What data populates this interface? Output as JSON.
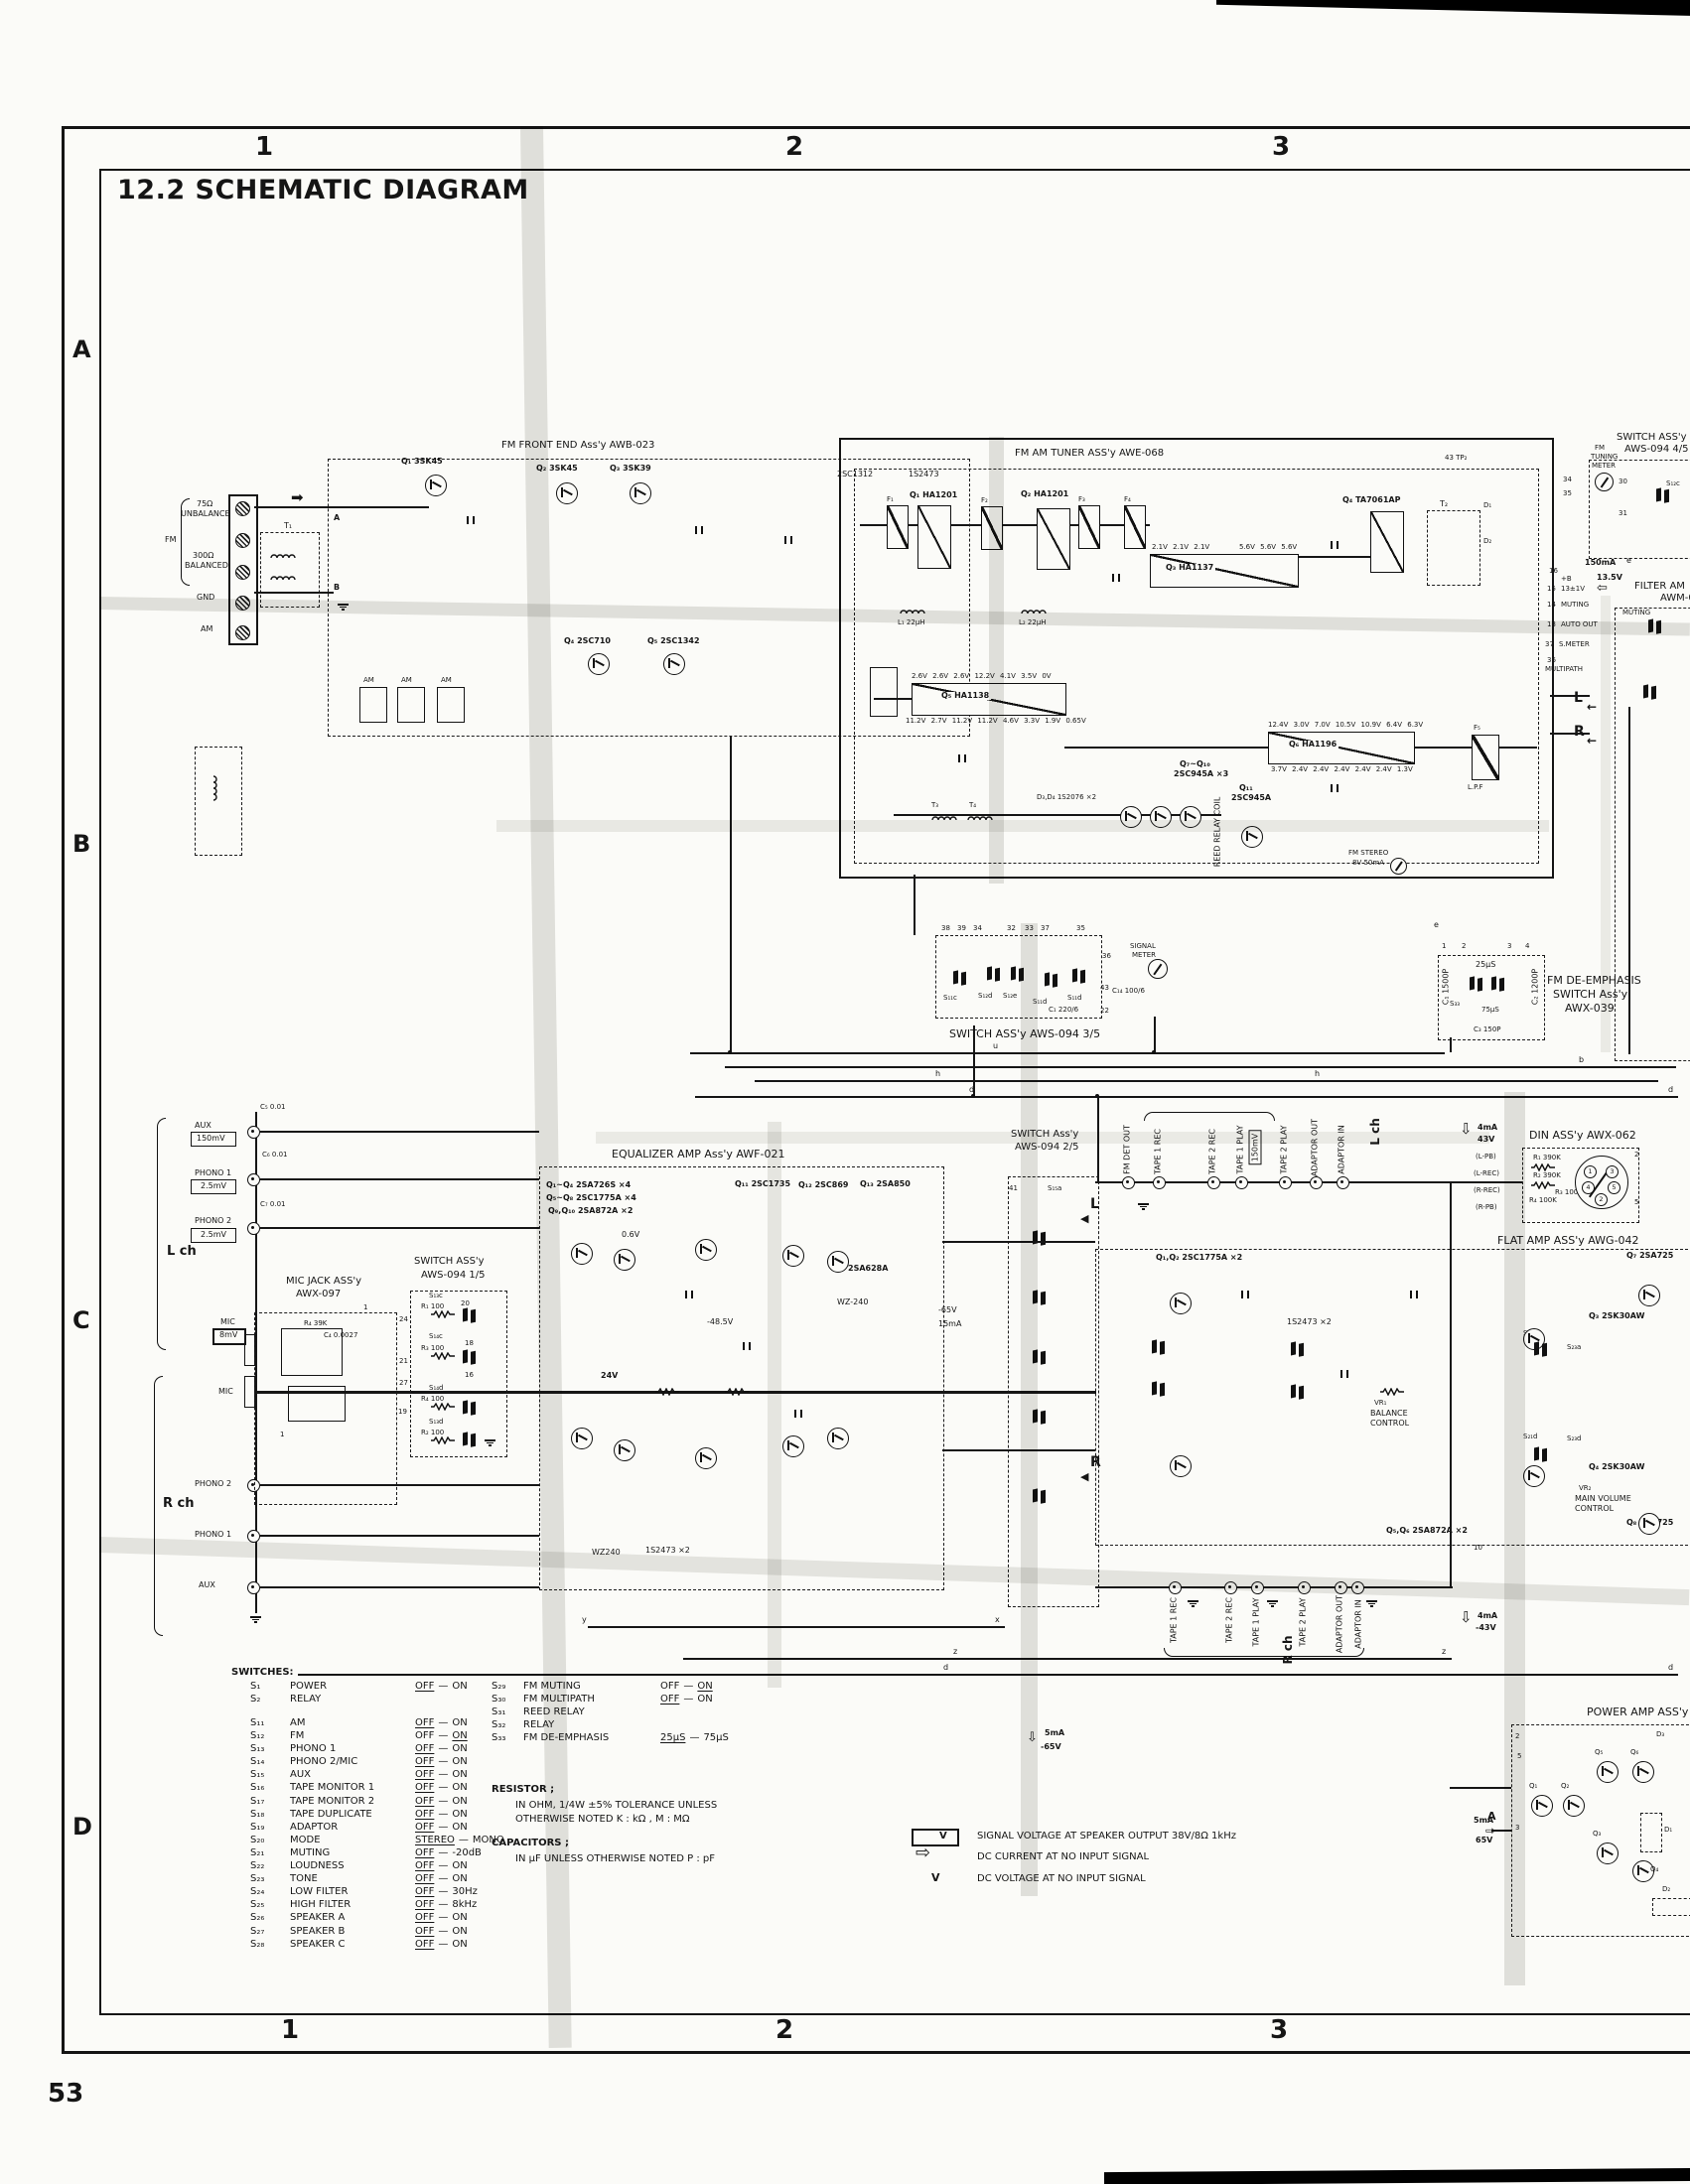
{
  "icons": {
    "arrow_right": "➡",
    "arrow_left": "←",
    "arrow_tri_left": "◀",
    "arrow_hollow_right": "⇨",
    "arrow_hollow_left": "⇦",
    "arrow_hollow_down": "⇩"
  },
  "pg": {
    "title": "12.2  SCHEMATIC DIAGRAM",
    "num": "53",
    "c1": "1",
    "c2": "2",
    "c3": "3",
    "b1": "1",
    "b2": "2",
    "b3": "3",
    "rA": "A",
    "rB": "B",
    "rC": "C",
    "rD": "D"
  },
  "term": {
    "ohm75": "75Ω",
    "unbal": "UNBALANCE",
    "fm": "FM",
    "ohm300": "300Ω",
    "bal": "BALANCED",
    "gnd": "GND",
    "am": "AM",
    "t1": "T₁",
    "a": "A",
    "b": "B"
  },
  "fe": {
    "name": "FM FRONT END Ass'y AWB-023",
    "q1": "Q₁ 3SK45",
    "q2": "Q₂ 3SK45",
    "q3": "Q₃ 3SK39",
    "q4": "Q₄ 2SC710",
    "q5": "Q₅ 2SC1342",
    "am": "AM"
  },
  "tun": {
    "name": "FM AM TUNER ASS'y AWE-068",
    "q1": "Q₁ HA1201",
    "q2": "Q₂ HA1201",
    "q3": "Q₃ HA1137",
    "q4": "Q₄ TA7061AP",
    "q5": "Q₅ HA1138",
    "q6": "Q₆ HA1196",
    "q710a": "Q₇~Q₁₀",
    "q710b": "2SC945A ×3",
    "q11a": "Q₁₁",
    "q11b": "2SC945A",
    "d34": "D₃,D₄ 1S2076 ×2",
    "c1312": "2SC1312",
    "d2473": "1S2473",
    "f1": "F₁",
    "f2": "F₂",
    "f3": "F₃",
    "f4": "F₄",
    "f5": "F₅",
    "lpf": "L.P.F",
    "t2": "T₂",
    "t3": "T₃",
    "t4": "T₄",
    "d1": "D₁",
    "d2": "D₂",
    "l1": "L₁ 22µH",
    "l2": "L₂ 22µH",
    "reed": "REED RELAY COIL",
    "tp2": "43 TP₂",
    "lamp1": "FM STEREO",
    "lamp2": "8V 50mA",
    "v5t": "2.6V 2.6V 2.6V 12.2V 4.1V 3.5V 0V",
    "v5b": "11.2V 2.7V 11.2V 11.2V 4.6V 3.3V 1.9V 0.65V",
    "v6t": "12.4V 3.0V 7.0V 10.5V 10.9V 6.4V 6.3V",
    "v6b": "3.7V 2.4V 2.4V 2.4V 2.4V 2.4V 1.3V",
    "v3a": "2.1V 2.1V 2.1V",
    "v3b": "5.6V 5.6V 5.6V"
  },
  "trt": {
    "sw1": "SWITCH ASS'y",
    "sw2": "AWS-094 4/5",
    "m1": "FM",
    "m2": "TUNING",
    "m3": "METER",
    "s12c": "S₁₂c",
    "p30": "30",
    "p31": "31",
    "p34": "34",
    "p35": "35",
    "i150": "150mA",
    "e": "e",
    "v135": "13.5V",
    "p16": "16",
    "pb": "+B",
    "p15": "15",
    "v131": "13±1V",
    "p14": "14",
    "mut": "MUTING",
    "p13": "13",
    "auto": "AUTO OUT",
    "p37": "37",
    "smet": "S.METER",
    "p36": "36",
    "mpath": "MULTIPATH",
    "L": "L",
    "R": "R",
    "f1": "FILTER AM",
    "f2": "AWM-0"
  },
  "de": {
    "l1": "FM DE-EMPHASIS",
    "l2": "SWITCH Ass'y",
    "l3": "AWX-039",
    "u25": "25µS",
    "u75": "75µS",
    "s33": "S₃₃",
    "c1": "C₁ 1500P",
    "c2": "C₂ 1200P",
    "c3": "C₃ 150P",
    "p1": "1",
    "p2": "2",
    "p3": "3",
    "p4": "4"
  },
  "s35": {
    "name": "SWITCH ASS'y AWS-094 3/5",
    "sg1": "SIGNAL",
    "sg2": "METER",
    "a": "S₁₁c",
    "b2": "S₁₂d",
    "c": "S₁₂e",
    "d": "S₁₁d",
    "e": "S₁₁d",
    "cc1": "C₁ 220/6",
    "cc14": "C₁₄ 100/6",
    "p38": "38",
    "p39": "39",
    "p34": "34",
    "p32": "32",
    "p33": "33",
    "p37": "37",
    "p35": "35",
    "p43": "43",
    "p22": "22",
    "p36": "36"
  },
  "bus": {
    "u": "u",
    "b": "b",
    "h": "h",
    "d": "d",
    "e": "e",
    "y": "y",
    "x": "x",
    "z": "z"
  },
  "inp": {
    "aux": "AUX",
    "aux_mv": "150mV",
    "ph1": "PHONO 1",
    "ph1_mv": "2.5mV",
    "ph2": "PHONO 2",
    "ph2_mv": "2.5mV",
    "lch": "L ch",
    "rch": "R ch",
    "mic": "MIC",
    "mic_mv": "8mV",
    "c5": "C₅ 0.01",
    "c6": "C₆ 0.01",
    "c7": "C₇ 0.01"
  },
  "eq": {
    "name": "EQUALIZER AMP Ass'y AWF-021",
    "p1": "Q₁~Q₄ 2SA726S ×4",
    "p2": "Q₅~Q₈ 2SC1775A ×4",
    "p3": "Q₉,Q₁₀ 2SA872A ×2",
    "q11": "Q₁₁ 2SC1735",
    "q12": "Q₁₂ 2SC869",
    "q13": "Q₁₃ 2SA850",
    "a628": "2SA628A",
    "wz1": "WZ-240",
    "wz2": "WZ240",
    "d1": "1S2473 ×2",
    "v1": "0.6V",
    "v2": "24V",
    "v3": "-48.5V",
    "v4": "-65V",
    "i1": "15mA"
  },
  "mj": {
    "l1": "MIC JACK ASS'y",
    "l2": "AWX-097",
    "r4": "R₄ 39K",
    "c4": "C₄ 0.0027",
    "p1": "1"
  },
  "s15": {
    "l1": "SWITCH ASS'y",
    "l2": "AWS-094 1/5",
    "s13c": "S₁₃c",
    "s14c": "S₁₄c",
    "s14d": "S₁₄d",
    "s13d": "S₁₃d",
    "r1": "R₁ 100",
    "r2": "R₂ 100",
    "r3": "R₃ 100",
    "r4": "R₄ 100",
    "p24": "24",
    "p21": "21",
    "p27": "27",
    "p19": "19",
    "p20": "20",
    "p18": "18",
    "p16": "16"
  },
  "s25": {
    "l1": "SWITCH Ass'y",
    "l2": "AWS-094 2/5",
    "p41": "41",
    "s15a": "S₁₅a",
    "L": "L",
    "R": "R"
  },
  "jt": {
    "fmdet": "FM DET OUT",
    "t1rec": "TAPE 1 REC",
    "t2rec": "TAPE 2 REC",
    "t1pl": "TAPE 1 PLAY",
    "mv": "150mV",
    "t2pl": "TAPE 2 PLAY",
    "ao": "ADAPTOR OUT",
    "ai": "ADAPTOR IN",
    "lch": "L ch",
    "i": "4mA",
    "v": "43V"
  },
  "jb": {
    "t1rec": "TAPE 1 REC",
    "t2rec": "TAPE 2 REC",
    "t1pl": "TAPE 1 PLAY",
    "t2pl": "TAPE 2 PLAY",
    "ao": "ADAPTOR OUT",
    "ai": "ADAPTOR IN",
    "rch": "R ch",
    "i": "4mA",
    "v": "-43V"
  },
  "din": {
    "name": "DIN ASS'y AWX-062",
    "lpb": "(L-PB)",
    "lrec": "(L-REC)",
    "rrec": "(R-REC)",
    "rpb": "(R-PB)",
    "r1": "R₁ 390K",
    "r2": "R₂ 390K",
    "r3": "R₃ 100K",
    "r4": "R₄ 100K",
    "p1": "1",
    "p2": "2",
    "p3": "3",
    "p4": "4",
    "p5": "5",
    "o2": "2",
    "o5": "5"
  },
  "fl": {
    "name": "FLAT AMP ASS'y AWG-042",
    "q12": "Q₁,Q₂ 2SC1775A ×2",
    "d1": "1S2473 ×2",
    "vr1": "VR₁",
    "bal1": "BALANCE",
    "bal2": "CONTROL",
    "q3": "Q₃ 2SK30AW",
    "q4": "Q₄ 2SK30AW",
    "q7": "Q₇ 2SA725",
    "q8": "Q₈ 2SA725",
    "vr2": "VR₂",
    "mv1": "MAIN VOLUME",
    "mv2": "CONTROL",
    "s21a": "S₂₁a",
    "s23a": "S₂₃a",
    "s21d": "S₂₁d",
    "s23d": "S₂₃d",
    "q56": "Q₅,Q₆ 2SA872A ×2",
    "p10": "10",
    "i5": "5mA",
    "v65": "-65V"
  },
  "pw": {
    "name": "POWER AMP ASS'y",
    "q1": "Q₁",
    "q2": "Q₂",
    "q3": "Q₃",
    "q4": "Q₄",
    "q5": "Q₅",
    "q6": "Q₆",
    "d1": "D₁",
    "d2": "D₂",
    "d3": "D₃",
    "p2": "2",
    "p3": "3",
    "p5": "5",
    "A": "A",
    "i5": "5mA",
    "v65": "65V"
  },
  "leg": {
    "vbox": "V",
    "r1": "SIGNAL VOLTAGE AT SPEAKER OUTPUT 38V/8Ω 1kHz",
    "r2": "DC CURRENT AT NO INPUT SIGNAL",
    "vplain": "V",
    "r3": "DC VOLTAGE AT NO INPUT SIGNAL"
  },
  "swl": {
    "head": "SWITCHES:",
    "g1": [
      {
        "id": "S₁",
        "name": "POWER",
        "p1": "OFF",
        "p2": "ON",
        "u1": "1",
        "u2": "0",
        "d": "—"
      },
      {
        "id": "S₂",
        "name": "RELAY",
        "p1": "",
        "p2": "",
        "u1": "0",
        "u2": "0",
        "d": ""
      }
    ],
    "g2": [
      {
        "id": "S₁₁",
        "name": "AM",
        "p1": "OFF",
        "p2": "ON",
        "u1": "1",
        "u2": "0",
        "d": "—"
      },
      {
        "id": "S₁₂",
        "name": "FM",
        "p1": "OFF",
        "p2": "ON",
        "u1": "0",
        "u2": "1",
        "d": "—"
      },
      {
        "id": "S₁₃",
        "name": "PHONO 1",
        "p1": "OFF",
        "p2": "ON",
        "u1": "1",
        "u2": "0",
        "d": "—"
      },
      {
        "id": "S₁₄",
        "name": "PHONO 2/MIC",
        "p1": "OFF",
        "p2": "ON",
        "u1": "1",
        "u2": "0",
        "d": "—"
      },
      {
        "id": "S₁₅",
        "name": "AUX",
        "p1": "OFF",
        "p2": "ON",
        "u1": "1",
        "u2": "0",
        "d": "—"
      },
      {
        "id": "S₁₆",
        "name": "TAPE MONITOR 1",
        "p1": "OFF",
        "p2": "ON",
        "u1": "1",
        "u2": "0",
        "d": "—"
      },
      {
        "id": "S₁₇",
        "name": "TAPE MONITOR 2",
        "p1": "OFF",
        "p2": "ON",
        "u1": "1",
        "u2": "0",
        "d": "—"
      },
      {
        "id": "S₁₈",
        "name": "TAPE DUPLICATE",
        "p1": "OFF",
        "p2": "ON",
        "u1": "1",
        "u2": "0",
        "d": "—"
      },
      {
        "id": "S₁₉",
        "name": "ADAPTOR",
        "p1": "OFF",
        "p2": "ON",
        "u1": "1",
        "u2": "0",
        "d": "—"
      },
      {
        "id": "S₂₀",
        "name": "MODE",
        "p1": "STEREO",
        "p2": "MONO",
        "u1": "1",
        "u2": "0",
        "d": "—"
      },
      {
        "id": "S₂₁",
        "name": "MUTING",
        "p1": "OFF",
        "p2": "-20dB",
        "u1": "1",
        "u2": "0",
        "d": "—"
      },
      {
        "id": "S₂₂",
        "name": "LOUDNESS",
        "p1": "OFF",
        "p2": "ON",
        "u1": "1",
        "u2": "0",
        "d": "—"
      },
      {
        "id": "S₂₃",
        "name": "TONE",
        "p1": "OFF",
        "p2": "ON",
        "u1": "1",
        "u2": "0",
        "d": "—"
      },
      {
        "id": "S₂₄",
        "name": "LOW FILTER",
        "p1": "OFF",
        "p2": "30Hz",
        "u1": "1",
        "u2": "0",
        "d": "—"
      },
      {
        "id": "S₂₅",
        "name": "HIGH FILTER",
        "p1": "OFF",
        "p2": "8kHz",
        "u1": "1",
        "u2": "0",
        "d": "—"
      },
      {
        "id": "S₂₆",
        "name": "SPEAKER A",
        "p1": "OFF",
        "p2": "ON",
        "u1": "1",
        "u2": "0",
        "d": "—"
      },
      {
        "id": "S₂₇",
        "name": "SPEAKER B",
        "p1": "OFF",
        "p2": "ON",
        "u1": "1",
        "u2": "0",
        "d": "—"
      },
      {
        "id": "S₂₈",
        "name": "SPEAKER C",
        "p1": "OFF",
        "p2": "ON",
        "u1": "1",
        "u2": "0",
        "d": "—"
      }
    ],
    "g3": [
      {
        "id": "S₂₉",
        "name": "FM MUTING",
        "p1": "OFF",
        "p2": "ON",
        "u1": "0",
        "u2": "1",
        "d": "—"
      },
      {
        "id": "S₃₀",
        "name": "FM MULTIPATH",
        "p1": "OFF",
        "p2": "ON",
        "u1": "1",
        "u2": "0",
        "d": "—"
      },
      {
        "id": "S₃₁",
        "name": "REED RELAY",
        "p1": "",
        "p2": "",
        "u1": "0",
        "u2": "0",
        "d": ""
      },
      {
        "id": "S₃₂",
        "name": "RELAY",
        "p1": "",
        "p2": "",
        "u1": "0",
        "u2": "0",
        "d": ""
      },
      {
        "id": "S₃₃",
        "name": "FM DE-EMPHASIS",
        "p1": "25µS",
        "p2": "75µS",
        "u1": "1",
        "u2": "0",
        "d": "—"
      }
    ]
  },
  "notes": {
    "rh": "RESISTOR ;",
    "r1": "IN OHM, 1/4W ±5% TOLERANCE UNLESS",
    "r2": "OTHERWISE NOTED  K : kΩ ,  M : MΩ",
    "ch": "CAPACITORS ;",
    "c1": "IN µF UNLESS OTHERWISE NOTED  P : pF"
  }
}
